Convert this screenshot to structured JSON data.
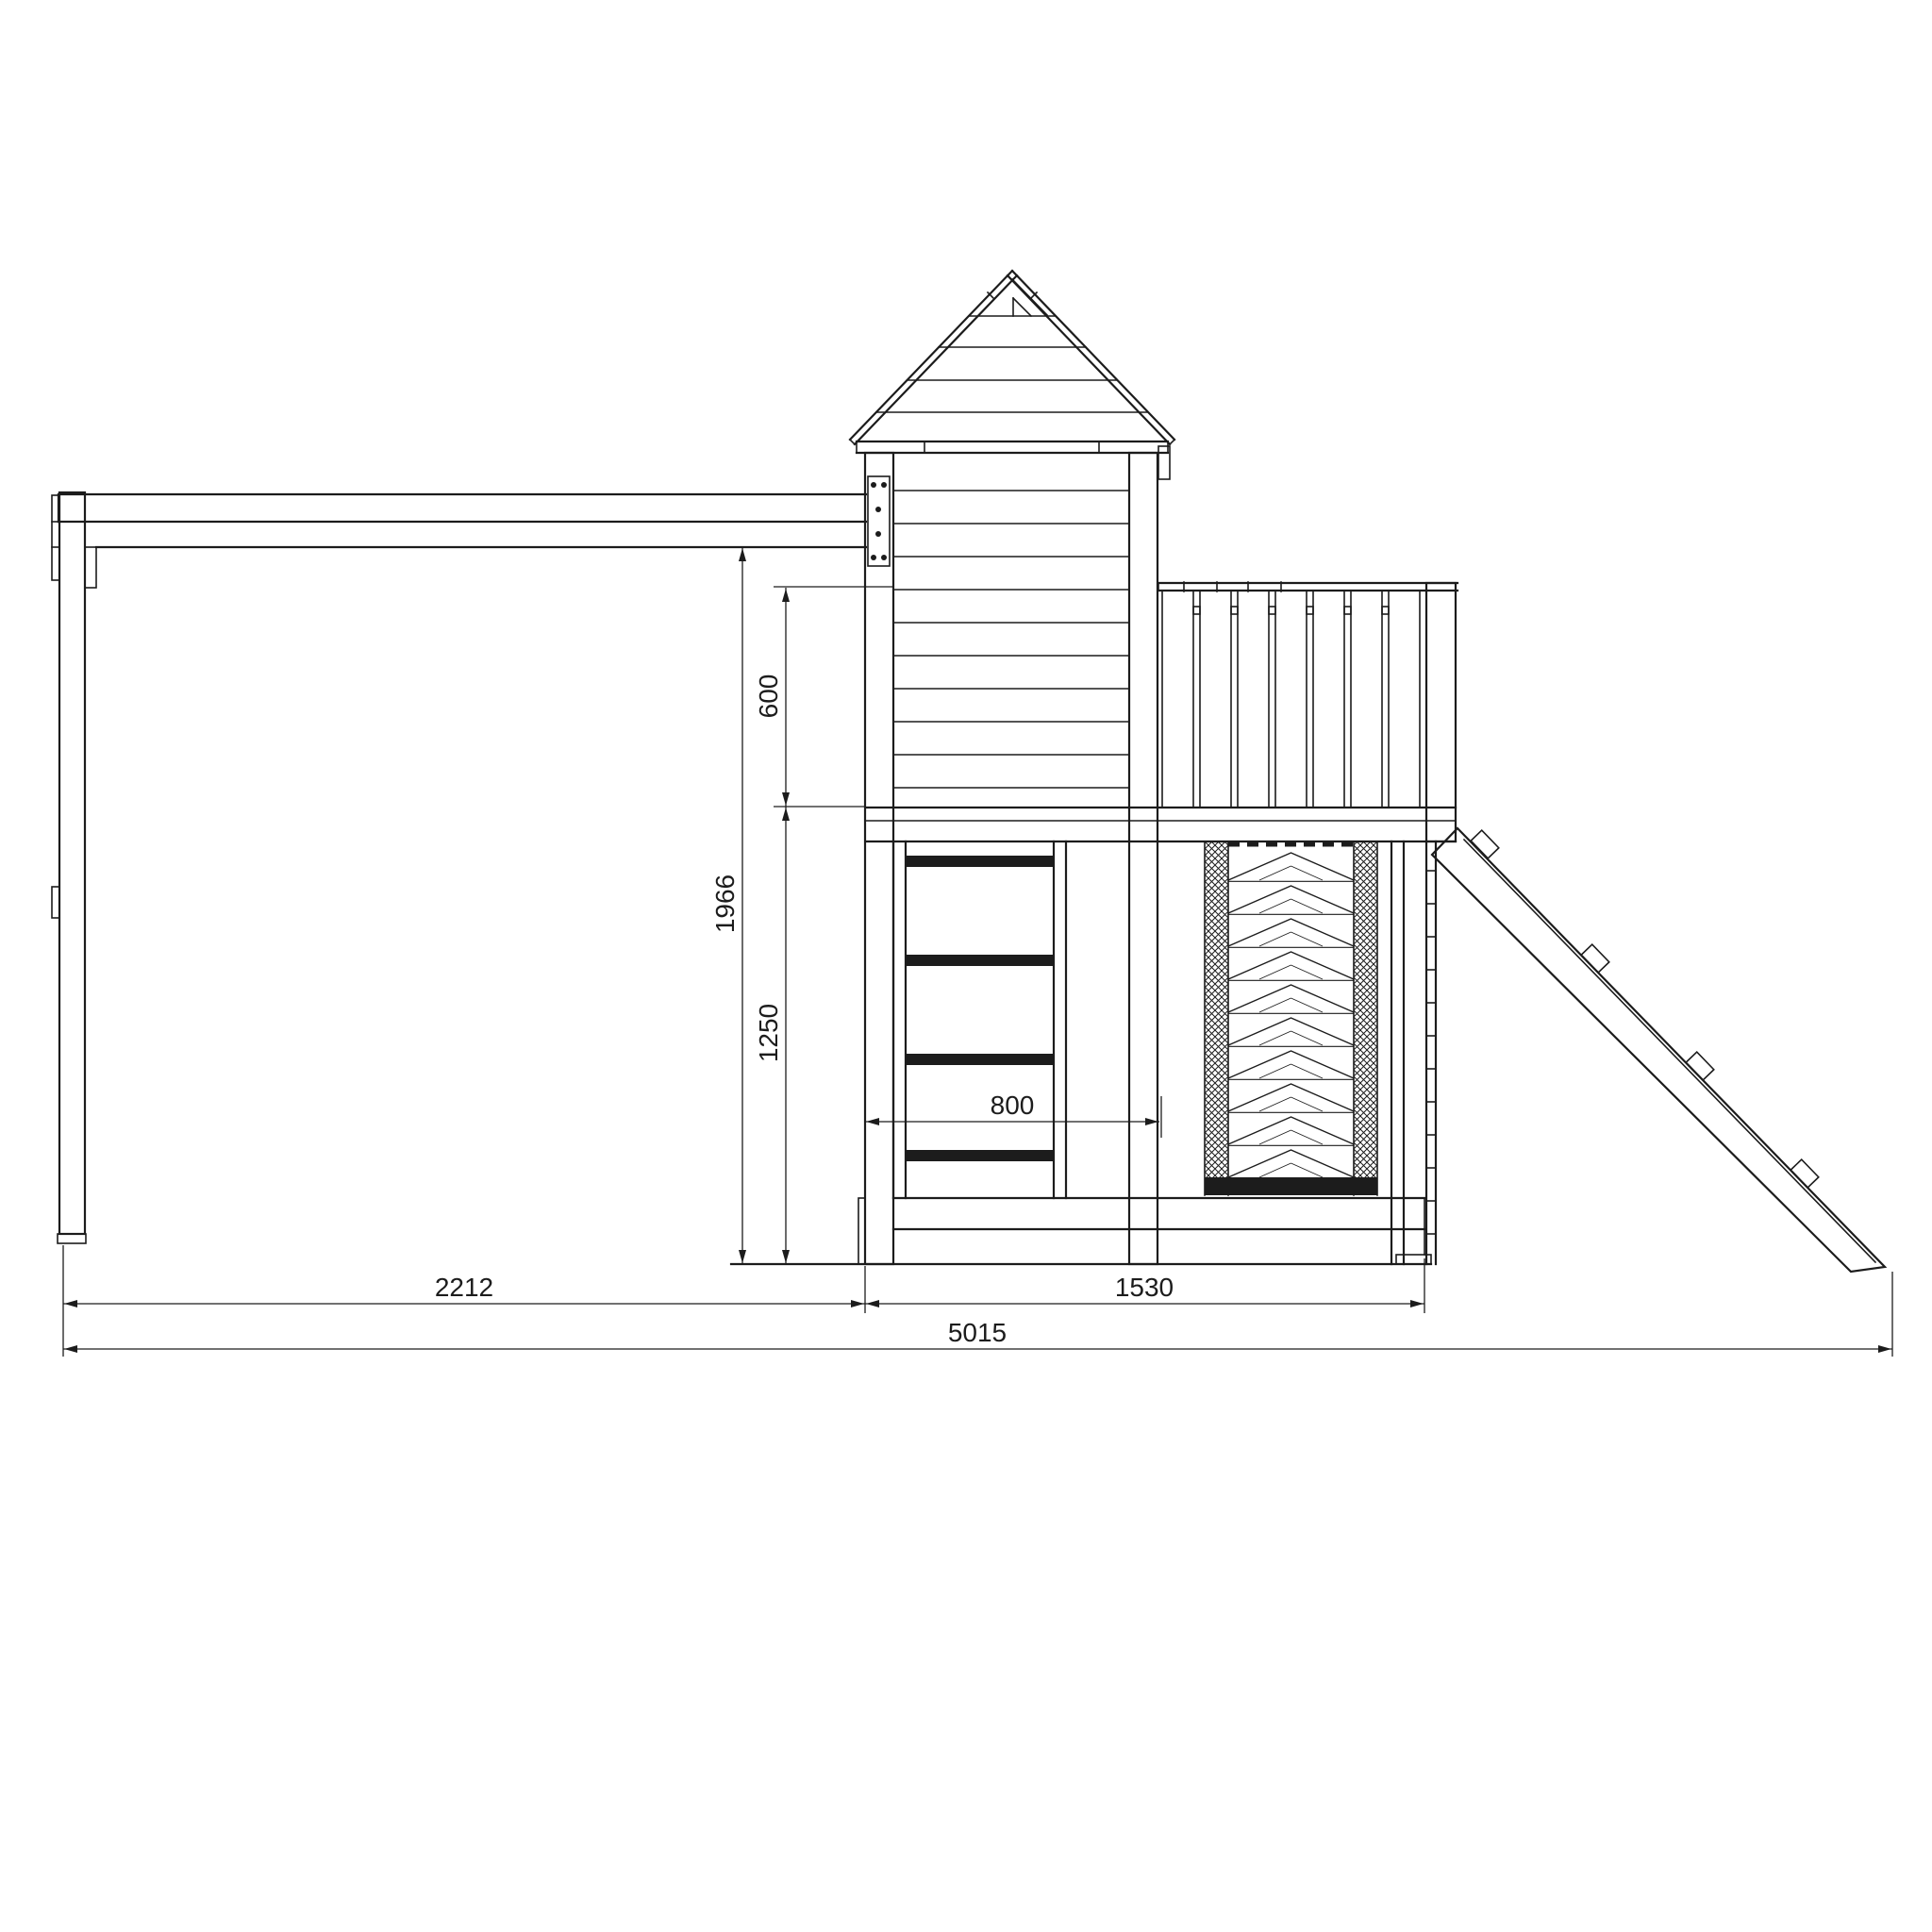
{
  "drawing": {
    "background": "#ffffff",
    "line_color": "#1c1c1c",
    "dimensions": {
      "swing_beam_height_mm": "1966",
      "railing_height_mm": "600",
      "under_platform_height_mm": "1250",
      "ladder_bay_width_mm": "800",
      "swing_section_length_mm": "2212",
      "tower_section_length_mm": "1530",
      "overall_length_mm": "5015"
    }
  }
}
